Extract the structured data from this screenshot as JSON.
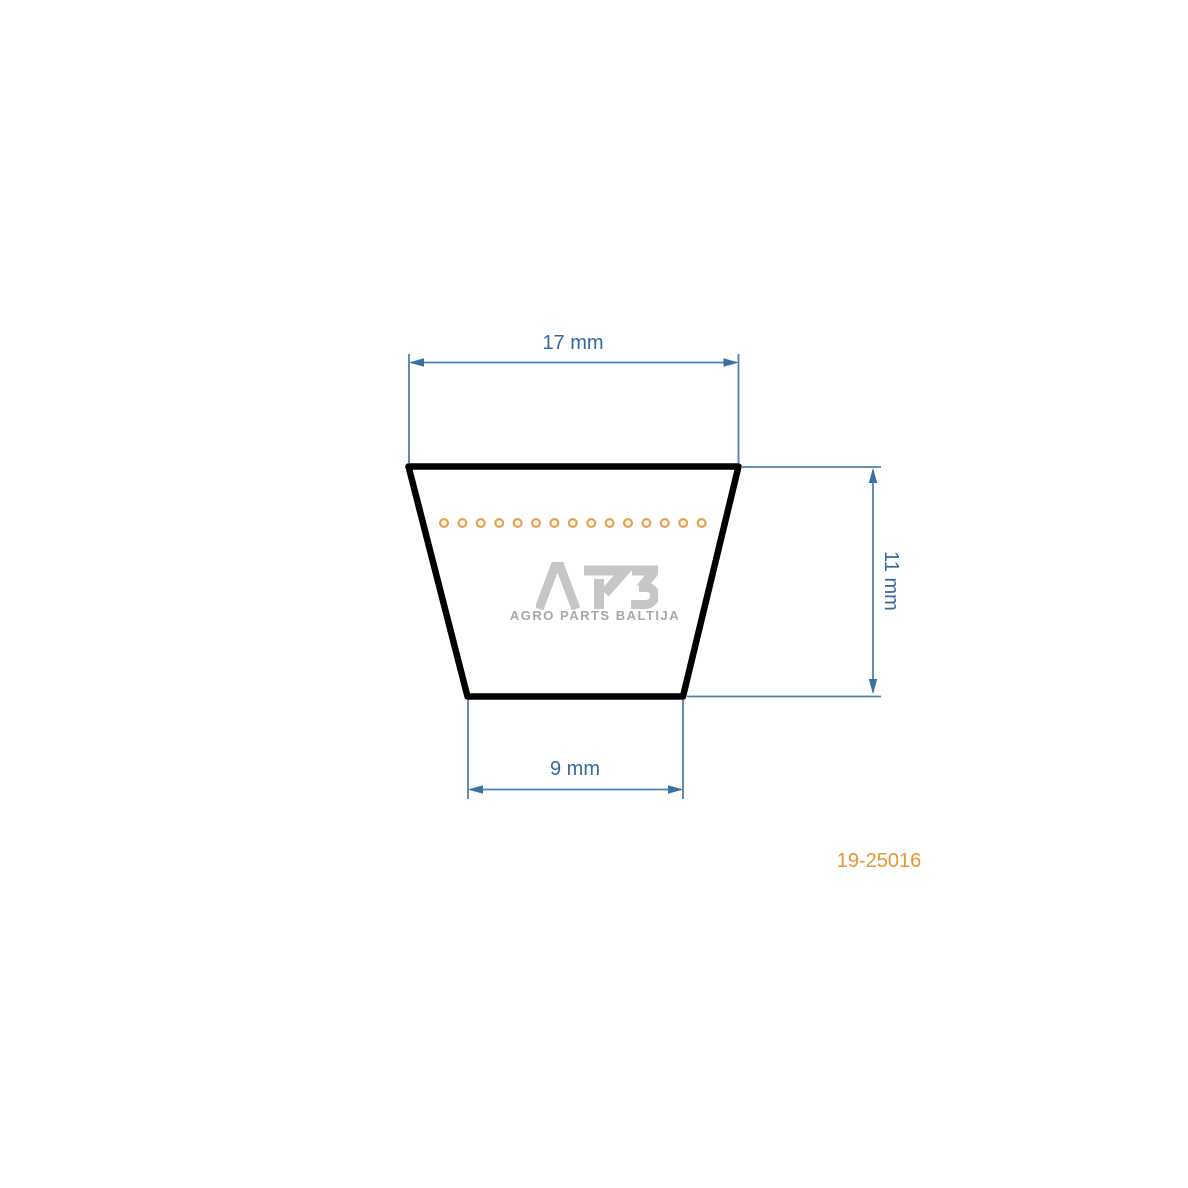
{
  "diagram": {
    "type": "v-belt cross-section technical drawing",
    "dimensions": {
      "top_width": {
        "label": "17 mm",
        "value_mm": 17
      },
      "height": {
        "label": "11 mm",
        "value_mm": 11
      },
      "bottom_width": {
        "label": "9 mm",
        "value_mm": 9
      }
    },
    "cord_circles": {
      "count": 15,
      "color": "#e8a24b"
    },
    "outline_color": "#000000",
    "dimension_line_color": "#4e81ae",
    "dimension_arrow_color": "#3a70a2",
    "dimension_text_color": "#34699e"
  },
  "watermark": {
    "logo": "APB",
    "subtitle": "AGRO PARTS BALTIJA",
    "logo_color": "#c6c6c6",
    "subtitle_color": "#a8a8a8"
  },
  "part_number": {
    "label": "19-25016",
    "color": "#e8962e"
  }
}
